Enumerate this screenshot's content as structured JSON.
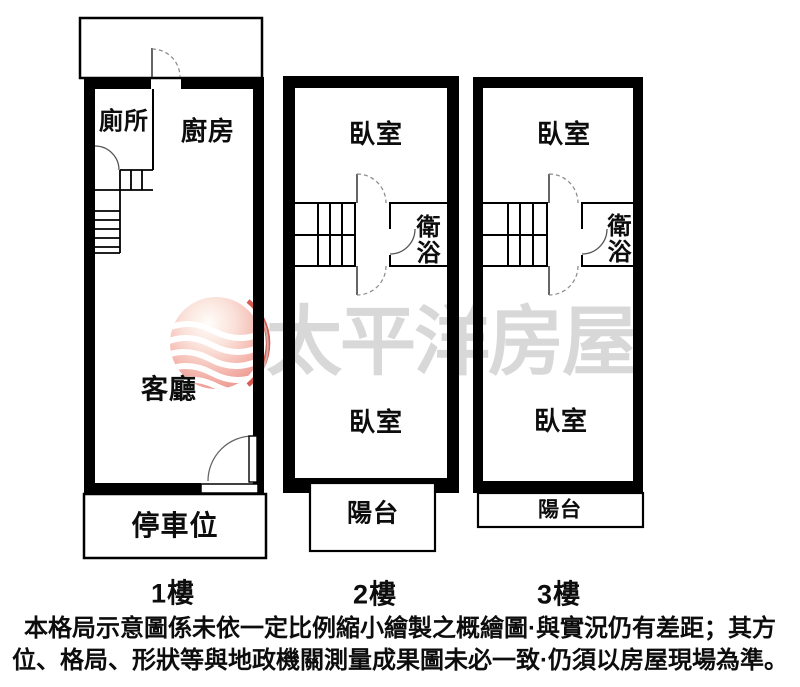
{
  "watermark": {
    "brand_text": "太平洋房屋",
    "logo": "pacific-globe-logo",
    "text_color": "#d8d8d8",
    "logo_red": "#d24a40"
  },
  "floors": [
    {
      "label": "1樓",
      "rooms": {
        "toilet": "廁所",
        "kitchen": "廚房",
        "living": "客廳",
        "parking": "停車位"
      }
    },
    {
      "label": "2樓",
      "rooms": {
        "bedroom_upper": "臥室",
        "bathroom": "衛浴",
        "bedroom_lower": "臥室",
        "balcony": "陽台"
      }
    },
    {
      "label": "3樓",
      "rooms": {
        "bedroom_upper": "臥室",
        "bathroom": "衛浴",
        "bedroom_lower": "臥室",
        "balcony": "陽台"
      }
    }
  ],
  "disclaimer": {
    "line1": "本格局示意圖係未依一定比例縮小繪製之概繪圖·與實況仍有差距；其方",
    "line2": "位、格局、形狀等與地政機關測量成果圖未必一致·仍須以房屋現場為準。"
  },
  "colors": {
    "wall": "#000000",
    "background": "#ffffff"
  }
}
